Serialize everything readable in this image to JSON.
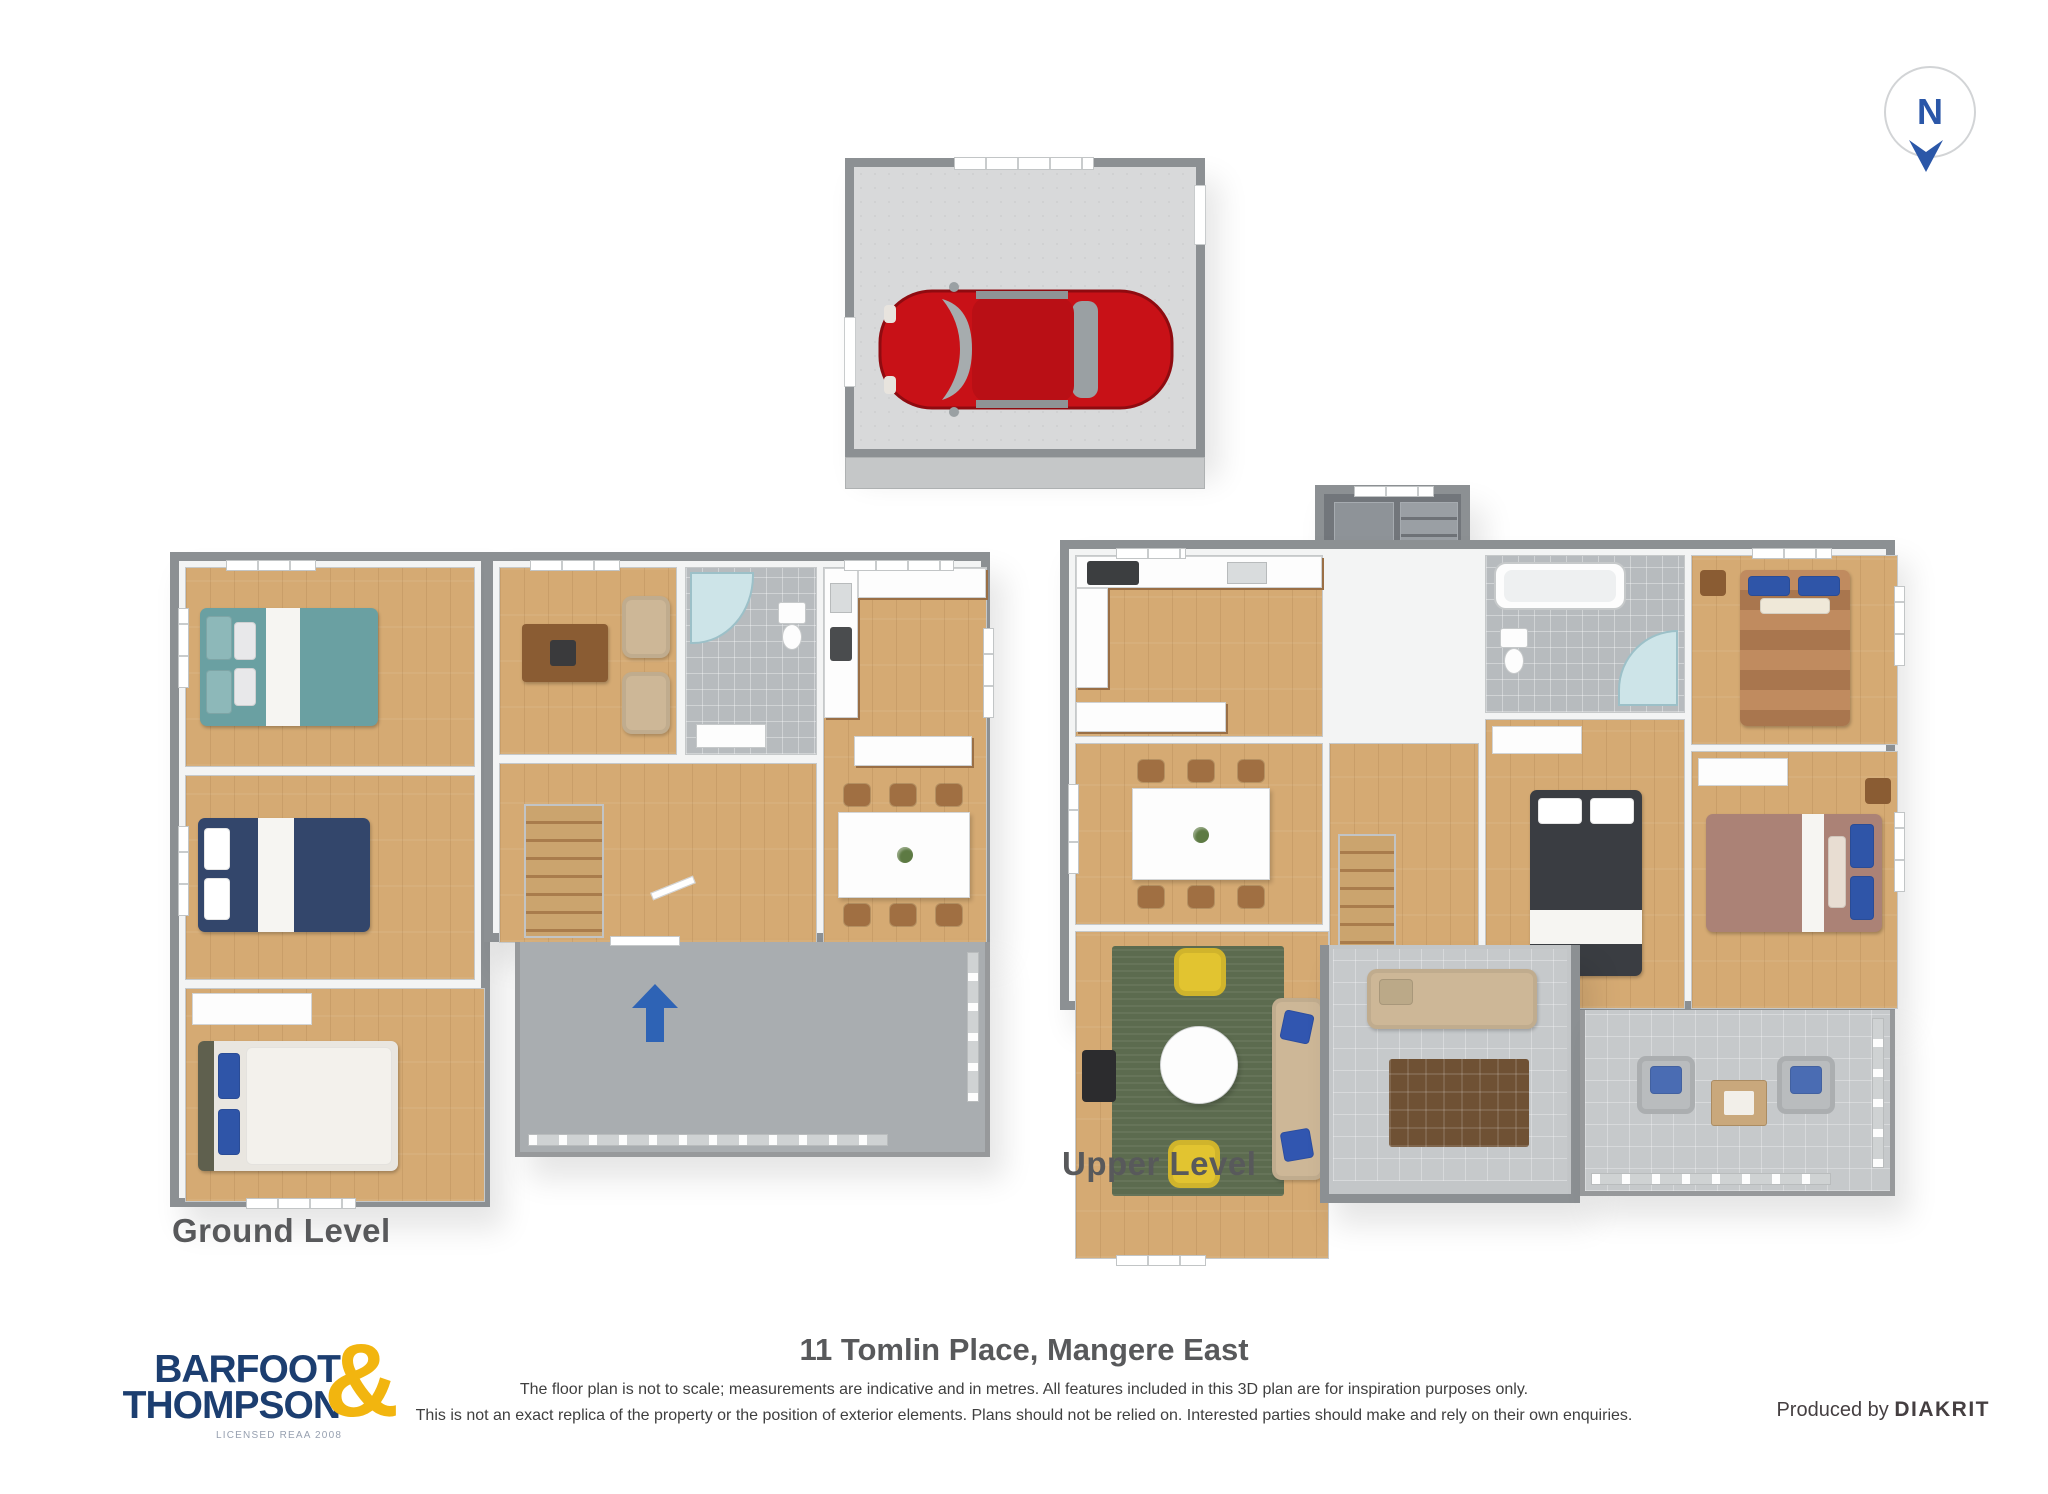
{
  "compass": {
    "letter": "N"
  },
  "plans": {
    "garage": {
      "name": "garage"
    },
    "ground": {
      "label": "Ground Level"
    },
    "upper": {
      "label": "Upper Level"
    }
  },
  "footer": {
    "address": "11 Tomlin Place, Mangere East",
    "disclaimer_line1": "The floor plan is not to scale; measurements are indicative and in metres. All features included in this 3D plan are for inspiration purposes only.",
    "disclaimer_line2": "This is not an exact replica of the property or the position of exterior elements. Plans should not be relied on. Interested parties should make and rely on their own enquiries.",
    "produced_by_label": "Produced by",
    "producer_name": "DIAKRIT",
    "logo": {
      "word1": "BARFOOT",
      "word2": "THOMPSON",
      "ampersand": "&",
      "tagline": "LICENSED REAA 2008"
    }
  },
  "colors": {
    "brand_navy": "#1c3e70",
    "brand_yellow": "#f2b50f",
    "compass_blue": "#2b57a8",
    "entrance_arrow_blue": "#2e63b5",
    "car_red": "#c81117",
    "wood_floor": "#d5aa73",
    "deck_gray": "#a9adb0",
    "wall_gray": "#8c9093",
    "label_gray": "#58595b"
  }
}
